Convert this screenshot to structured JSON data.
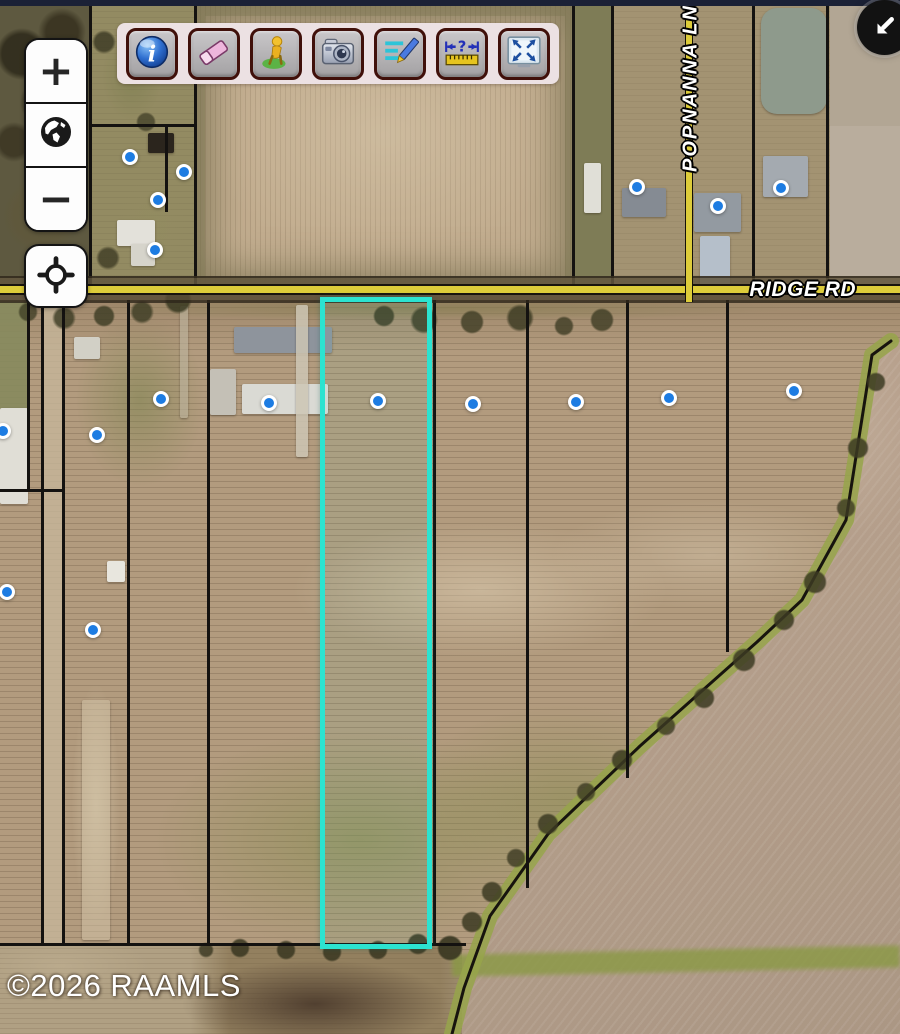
{
  "top_bar": {
    "color": "#1b2136"
  },
  "toolbar": {
    "background_color": "#ece1e3",
    "buttons": [
      {
        "name": "identify",
        "icon": "info-icon"
      },
      {
        "name": "erase",
        "icon": "eraser-icon"
      },
      {
        "name": "person-tool",
        "icon": "person-icon"
      },
      {
        "name": "photos",
        "icon": "camera-icon"
      },
      {
        "name": "edit-notes",
        "icon": "notes-pencil-icon"
      },
      {
        "name": "measure-distance",
        "icon": "ruler-question-icon"
      },
      {
        "name": "zoom-full-extent",
        "icon": "screen-arrows-icon"
      }
    ]
  },
  "map_controls": {
    "zoom_in_label": "+",
    "zoom_out_label": "−",
    "globe_icon": "globe-icon",
    "locate_icon": "crosshair-icon"
  },
  "collapse_button": {
    "icon": "arrow-down-left-icon"
  },
  "map": {
    "roads": [
      {
        "label": "RIDGE RD",
        "orientation": "horizontal",
        "color": "#ddcc3a"
      },
      {
        "label": "POPNANNA LN",
        "orientation": "vertical",
        "color": "#ddcc3a"
      }
    ],
    "selection": {
      "stroke_color": "#2ce3d0",
      "x": 320,
      "y": 297,
      "width": 112,
      "height": 652
    },
    "marker_style": {
      "fill": "#1d7ce2",
      "ring": "#ffffff"
    },
    "markers": [
      {
        "x": 130,
        "y": 157
      },
      {
        "x": 184,
        "y": 172
      },
      {
        "x": 158,
        "y": 200
      },
      {
        "x": 155,
        "y": 250
      },
      {
        "x": 637,
        "y": 187
      },
      {
        "x": 718,
        "y": 206
      },
      {
        "x": 781,
        "y": 188
      },
      {
        "x": 161,
        "y": 399
      },
      {
        "x": 269,
        "y": 403
      },
      {
        "x": 378,
        "y": 401
      },
      {
        "x": 473,
        "y": 404
      },
      {
        "x": 576,
        "y": 402
      },
      {
        "x": 669,
        "y": 398
      },
      {
        "x": 794,
        "y": 391
      },
      {
        "x": 3,
        "y": 431
      },
      {
        "x": 97,
        "y": 435
      },
      {
        "x": 7,
        "y": 592
      },
      {
        "x": 93,
        "y": 630
      }
    ],
    "parcel_lines": [
      {
        "x": 90,
        "y1": 6,
        "y2": 288
      },
      {
        "x": 195,
        "y1": 6,
        "y2": 288
      },
      {
        "x": 573,
        "y1": 6,
        "y2": 288
      },
      {
        "x": 612,
        "y1": 6,
        "y2": 288
      },
      {
        "x": 753,
        "y1": 6,
        "y2": 288
      },
      {
        "x": 827,
        "y1": 6,
        "y2": 288
      },
      {
        "x": 166,
        "y1": 125,
        "y2": 212
      },
      {
        "y": 125,
        "x1": 90,
        "x2": 195
      },
      {
        "x": 28,
        "y1": 300,
        "y2": 490
      },
      {
        "x": 42,
        "y1": 300,
        "y2": 944
      },
      {
        "x": 63,
        "y1": 300,
        "y2": 944
      },
      {
        "x": 128,
        "y1": 300,
        "y2": 944
      },
      {
        "x": 208,
        "y1": 300,
        "y2": 944
      },
      {
        "x": 322,
        "y1": 300,
        "y2": 946
      },
      {
        "x": 434,
        "y1": 300,
        "y2": 946
      },
      {
        "x": 527,
        "y1": 300,
        "y2": 888
      },
      {
        "x": 627,
        "y1": 300,
        "y2": 778
      },
      {
        "x": 727,
        "y1": 300,
        "y2": 652
      },
      {
        "y": 490,
        "x1": 0,
        "x2": 63
      },
      {
        "y": 944,
        "x1": 0,
        "x2": 466
      }
    ],
    "buildings": [
      {
        "x": 117,
        "y": 220,
        "w": 38,
        "h": 26,
        "c": "#e3e1da",
        "n": "house"
      },
      {
        "x": 131,
        "y": 244,
        "w": 24,
        "h": 22,
        "c": "#d6d4cb",
        "n": "house"
      },
      {
        "x": 148,
        "y": 133,
        "w": 26,
        "h": 20,
        "c": "#2b251d",
        "n": "barn"
      },
      {
        "x": 74,
        "y": 337,
        "w": 26,
        "h": 22,
        "c": "#d2d0c6",
        "n": "shed"
      },
      {
        "x": 0,
        "y": 408,
        "w": 28,
        "h": 96,
        "c": "#e0ded6",
        "n": "building"
      },
      {
        "x": 107,
        "y": 561,
        "w": 18,
        "h": 21,
        "c": "#e8e6de",
        "n": "shed"
      },
      {
        "x": 210,
        "y": 369,
        "w": 26,
        "h": 46,
        "c": "#c4c0b6",
        "n": "shed"
      },
      {
        "x": 234,
        "y": 327,
        "w": 98,
        "h": 26,
        "c": "#8e949c",
        "n": "house"
      },
      {
        "x": 242,
        "y": 384,
        "w": 86,
        "h": 30,
        "c": "#dadad4",
        "n": "house"
      },
      {
        "x": 584,
        "y": 163,
        "w": 17,
        "h": 50,
        "c": "#e0dfd7",
        "n": "shed"
      },
      {
        "x": 622,
        "y": 188,
        "w": 44,
        "h": 29,
        "c": "#858b93",
        "n": "house"
      },
      {
        "x": 694,
        "y": 193,
        "w": 47,
        "h": 39,
        "c": "#939aa1",
        "n": "house"
      },
      {
        "x": 763,
        "y": 156,
        "w": 45,
        "h": 41,
        "c": "#a4aab0",
        "n": "house"
      },
      {
        "x": 700,
        "y": 236,
        "w": 30,
        "h": 52,
        "c": "#b5bfca",
        "n": "house"
      },
      {
        "x": 296,
        "y": 305,
        "w": 12,
        "h": 152,
        "c": "rgba(205,198,180,0.85)",
        "n": "driveway"
      },
      {
        "x": 180,
        "y": 306,
        "w": 8,
        "h": 112,
        "c": "rgba(190,182,160,0.6)",
        "n": "driveway"
      },
      {
        "x": 82,
        "y": 700,
        "w": 28,
        "h": 240,
        "c": "rgba(212,198,170,0.5)",
        "n": "field-path"
      },
      {
        "x": 761,
        "y": 8,
        "w": 66,
        "h": 106,
        "c": "#8e9a8c",
        "r": 16,
        "n": "pond"
      }
    ],
    "tree_line": {
      "points": [
        [
          891,
          341
        ],
        [
          872,
          355
        ],
        [
          846,
          520
        ],
        [
          802,
          600
        ],
        [
          757,
          642
        ],
        [
          640,
          746
        ],
        [
          548,
          834
        ],
        [
          490,
          916
        ],
        [
          464,
          988
        ],
        [
          452,
          1034
        ]
      ],
      "grass_color": "rgba(150,164,74,0.85)",
      "line_color": "#17140e"
    }
  },
  "copyright": "©2026 RAAMLS"
}
